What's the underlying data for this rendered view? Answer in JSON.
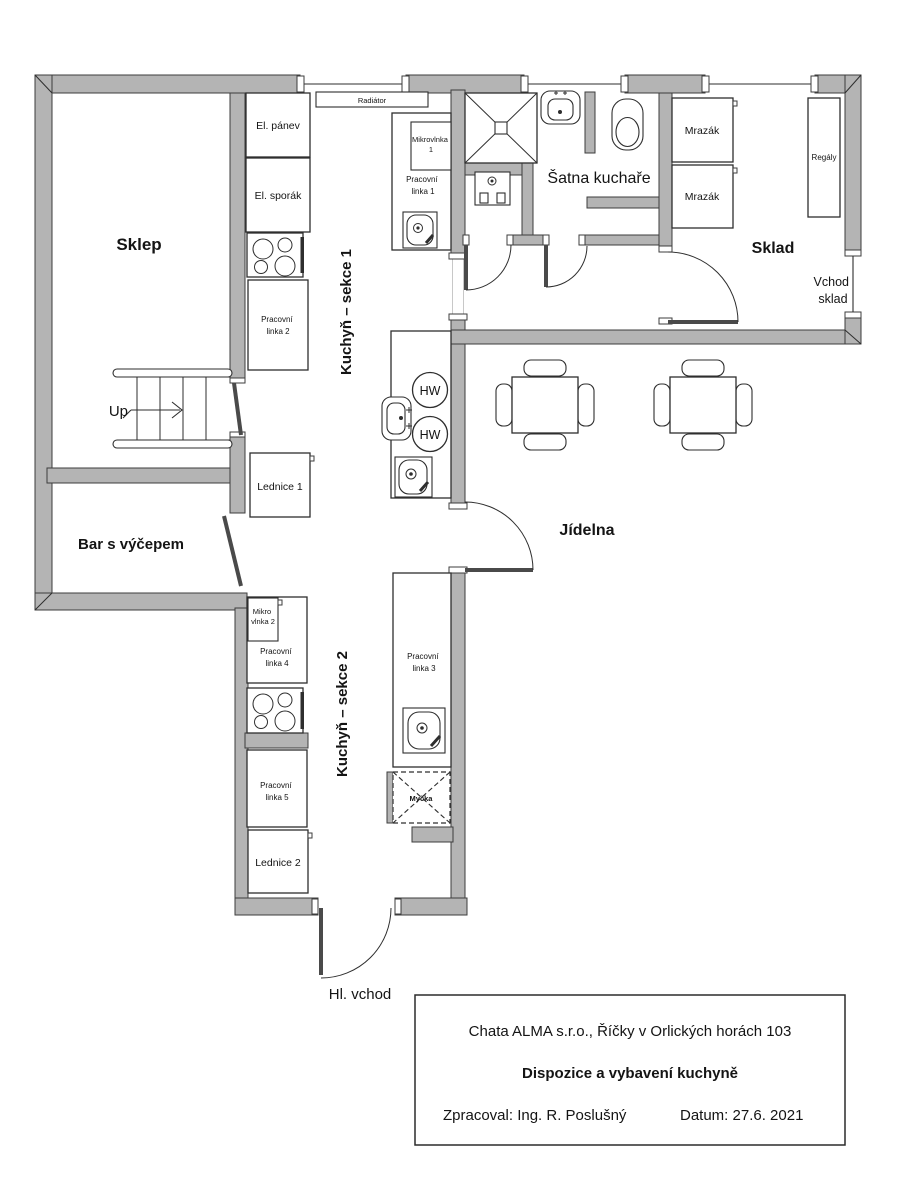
{
  "page": {
    "background": "#ffffff",
    "wall_color": "#b4b4b4",
    "line_color": "#2e2e2e"
  },
  "rooms": {
    "sklep": "Sklep",
    "bar": "Bar s výčepem",
    "kuchyn_sekce_1": "Kuchyň – sekce 1",
    "kuchyn_sekce_2": "Kuchyň – sekce 2",
    "satna_kuchare": "Šatna kuchaře",
    "sklad": "Sklad",
    "jidelna": "Jídelna"
  },
  "fixtures": {
    "radiator": "Radiátor",
    "el_panev": "El. pánev",
    "el_sporak": "El. sporák",
    "pracovni_linka_1": [
      "Pracovní",
      "linka 1"
    ],
    "pracovni_linka_2": [
      "Pracovní",
      "linka 2"
    ],
    "pracovni_linka_3": [
      "Pracovní",
      "linka 3"
    ],
    "pracovni_linka_4": [
      "Pracovní",
      "linka 4"
    ],
    "pracovni_linka_5": [
      "Pracovní",
      "linka 5"
    ],
    "mikrovlnka_1": [
      "Mikrovlnka",
      "1"
    ],
    "mikro_vlnka_2": [
      "Mikro",
      "vlnka 2"
    ],
    "lednice_1": "Lednice 1",
    "lednice_2": "Lednice 2",
    "mrazak": "Mrazák",
    "regaly": "Regály",
    "mycka": "Myčka",
    "hw": "HW"
  },
  "annotations": {
    "up": "Up",
    "hl_vchod": "Hl. vchod",
    "vchod_sklad": [
      "Vchod",
      "sklad"
    ]
  },
  "title_block": {
    "line1": "Chata ALMA s.r.o., Říčky v Orlických horách 103",
    "line2": "Dispozice a vybavení kuchyně",
    "zpracoval": "Zpracoval: Ing. R. Poslušný",
    "datum": "Datum: 27.6. 2021"
  }
}
